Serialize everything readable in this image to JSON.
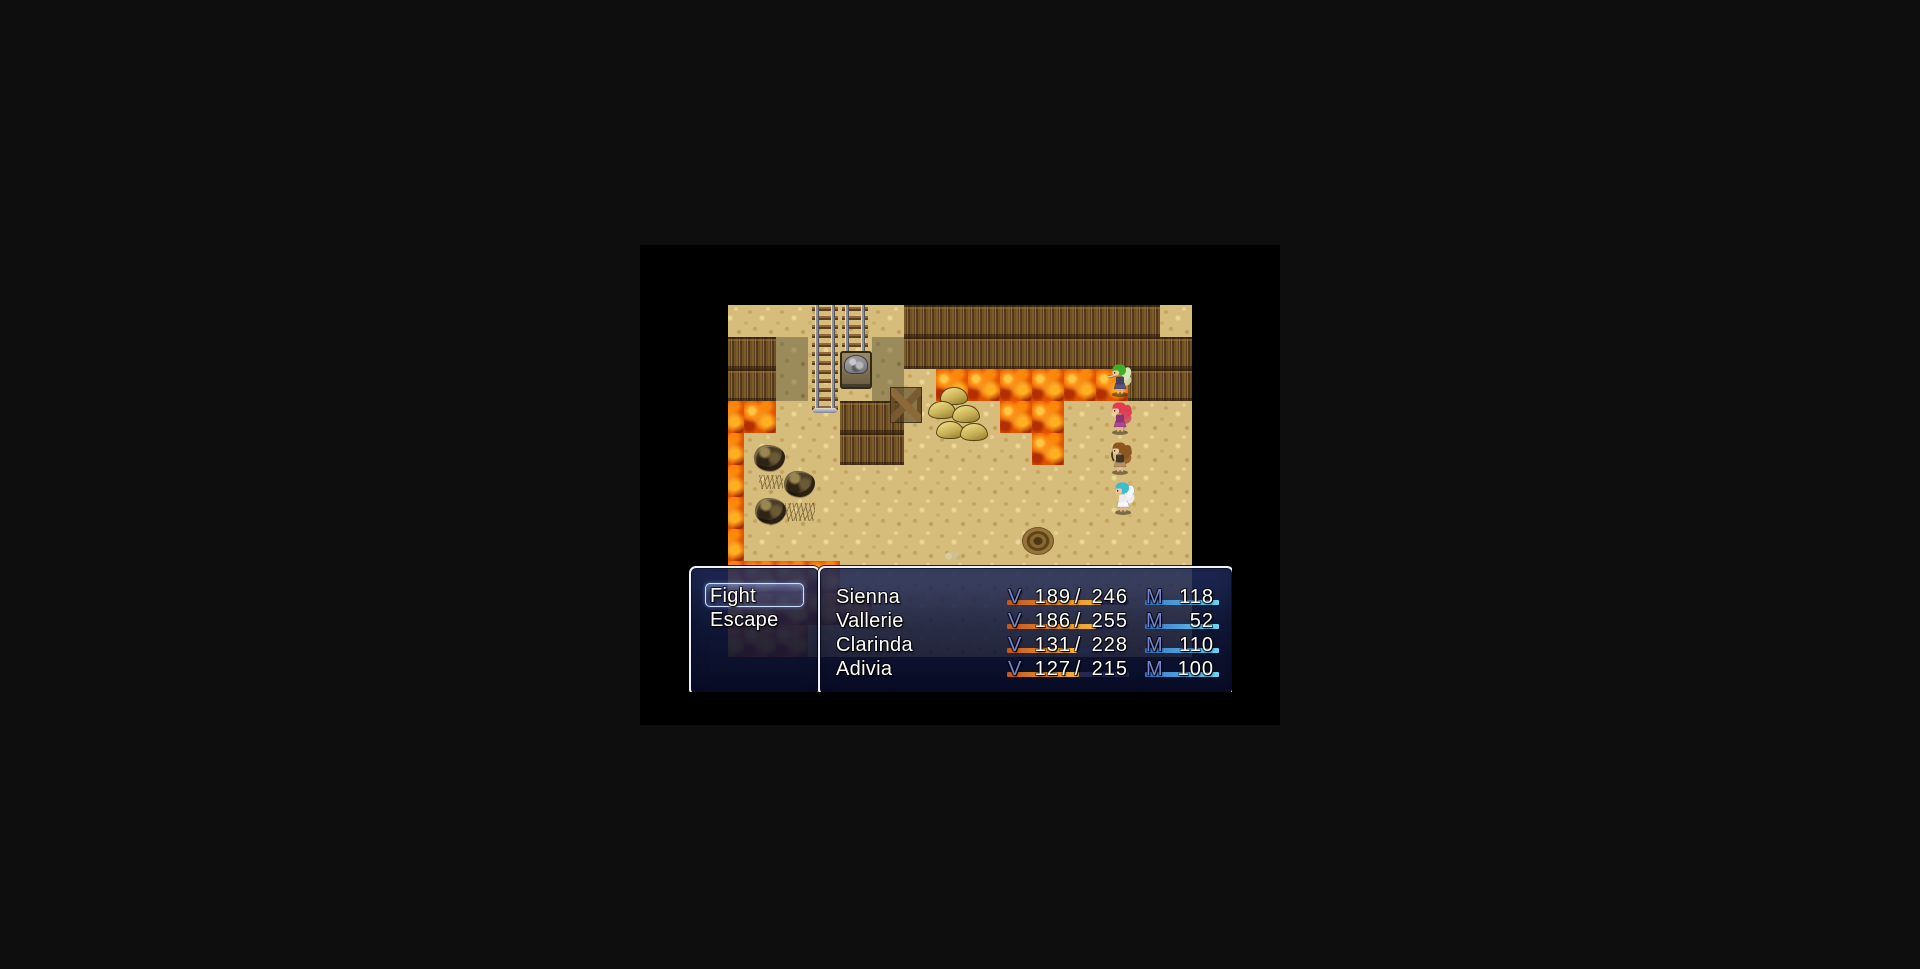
{
  "screen": {
    "desktop_bg": "#0e0e0e",
    "game_frame_bg": "#000000"
  },
  "map": {
    "tile_size": 32,
    "offset_x": -16,
    "palette": {
      "sand": "#d6bd7b",
      "sand_shadow": "#b29b66",
      "cliff_wall": "#6b4a22",
      "lava": "#e25400",
      "lava_bright": "#ffb428",
      "lava_dark": "#a82600"
    },
    "legend": {
      "S": "sand",
      "D": "sand-shadow",
      "W": "cliff-wall",
      "L": "lava"
    },
    "rows": [
      "SSSSSSWWWWWWWWSS",
      "WWDSSDWWWWWWWWWW",
      "WWDSSDSLLLLLLWWW",
      "LLSSWWSSSLLSSSSS",
      "LSSSWWSSSSLSSSSS",
      "LSSSSSSSSSSSSSSS",
      "LSSSSSSSSSSSSSSS",
      "LSSSSSSSSSSSSSSS",
      "LLLLSSSSSSSSSSSS",
      "LLLLLSSSSSSSSSSS",
      "LLLSSSSSSSSSSSSS"
    ],
    "objects": [
      {
        "type": "track",
        "x": 84,
        "y": 0,
        "w": 26,
        "h": 108
      },
      {
        "type": "track",
        "x": 114,
        "y": 0,
        "w": 26,
        "h": 82
      },
      {
        "type": "minecart",
        "x": 112,
        "y": 46,
        "w": 28,
        "h": 34
      },
      {
        "type": "support",
        "x": 162,
        "y": 82,
        "w": 30,
        "h": 34
      },
      {
        "type": "ore-cluster",
        "x": 200,
        "y": 80,
        "w": 62,
        "h": 56,
        "mounds": [
          [
            12,
            2
          ],
          [
            0,
            16
          ],
          [
            24,
            20
          ],
          [
            8,
            36
          ],
          [
            32,
            38
          ]
        ]
      },
      {
        "type": "rock",
        "x": 26,
        "y": 140,
        "w": 31,
        "h": 26
      },
      {
        "type": "rock",
        "x": 56,
        "y": 166,
        "w": 31,
        "h": 26
      },
      {
        "type": "rock",
        "x": 27,
        "y": 193,
        "w": 31,
        "h": 26
      },
      {
        "type": "grass",
        "x": 31,
        "y": 170,
        "w": 24,
        "h": 14
      },
      {
        "type": "grass",
        "x": 57,
        "y": 198,
        "w": 30,
        "h": 18
      },
      {
        "type": "rope",
        "x": 294,
        "y": 222,
        "w": 32,
        "h": 28
      },
      {
        "type": "bones",
        "x": 216,
        "y": 246,
        "w": 18,
        "h": 10
      }
    ],
    "actors": [
      {
        "name": "Sienna",
        "x": 380,
        "y": 58,
        "hair": "#3fae2a",
        "outfit": "#46405e",
        "dress": "#5c5480",
        "wing": "#d8e4b4",
        "pony": false,
        "weapon": "sword"
      },
      {
        "name": "Vallerie",
        "x": 380,
        "y": 96,
        "hair": "#e23a50",
        "outfit": "#8e3276",
        "dress": "#aa4890",
        "wing": "#d24a5c",
        "pony": true,
        "weapon": null
      },
      {
        "name": "Clarinda",
        "x": 380,
        "y": 136,
        "hair": "#8c5620",
        "outfit": "#443626",
        "dress": "#b69260",
        "wing": "#8c5620",
        "pony": true,
        "weapon": "bow"
      },
      {
        "name": "Adivia",
        "x": 383,
        "y": 176,
        "hair": "#3cbccc",
        "outfit": "#ececf4",
        "dress": "#f8f8fc",
        "wing": "#f2f7ff",
        "pony": false,
        "weapon": null
      }
    ]
  },
  "battle_ui": {
    "command_window": {
      "items": [
        {
          "label": "Fight",
          "selected": true
        },
        {
          "label": "Escape",
          "selected": false
        }
      ]
    },
    "status_window": {
      "hp_label": "V",
      "hp_separator": "/",
      "mp_label": "M",
      "party": [
        {
          "name": "Sienna",
          "hp": 189,
          "hp_max": 246,
          "mp": 118,
          "hp_ratio": 0.768,
          "mp_ratio": 1
        },
        {
          "name": "Vallerie",
          "hp": 186,
          "hp_max": 255,
          "mp": 52,
          "hp_ratio": 0.729,
          "mp_ratio": 1
        },
        {
          "name": "Clarinda",
          "hp": 131,
          "hp_max": 228,
          "mp": 110,
          "hp_ratio": 0.575,
          "mp_ratio": 1
        },
        {
          "name": "Adivia",
          "hp": 127,
          "hp_max": 215,
          "mp": 100,
          "hp_ratio": 0.591,
          "mp_ratio": 1
        }
      ]
    },
    "colors": {
      "stat_label": "#7585d2",
      "text": "#ffffff",
      "window_border": "#eef2f8",
      "gauge_bg": "#23284e",
      "hp_gauge": [
        "#c2551e",
        "#f5b33c"
      ],
      "mp_gauge": [
        "#3a74c4",
        "#6cd4f4"
      ],
      "cursor_border": "#cfe0ff"
    }
  }
}
